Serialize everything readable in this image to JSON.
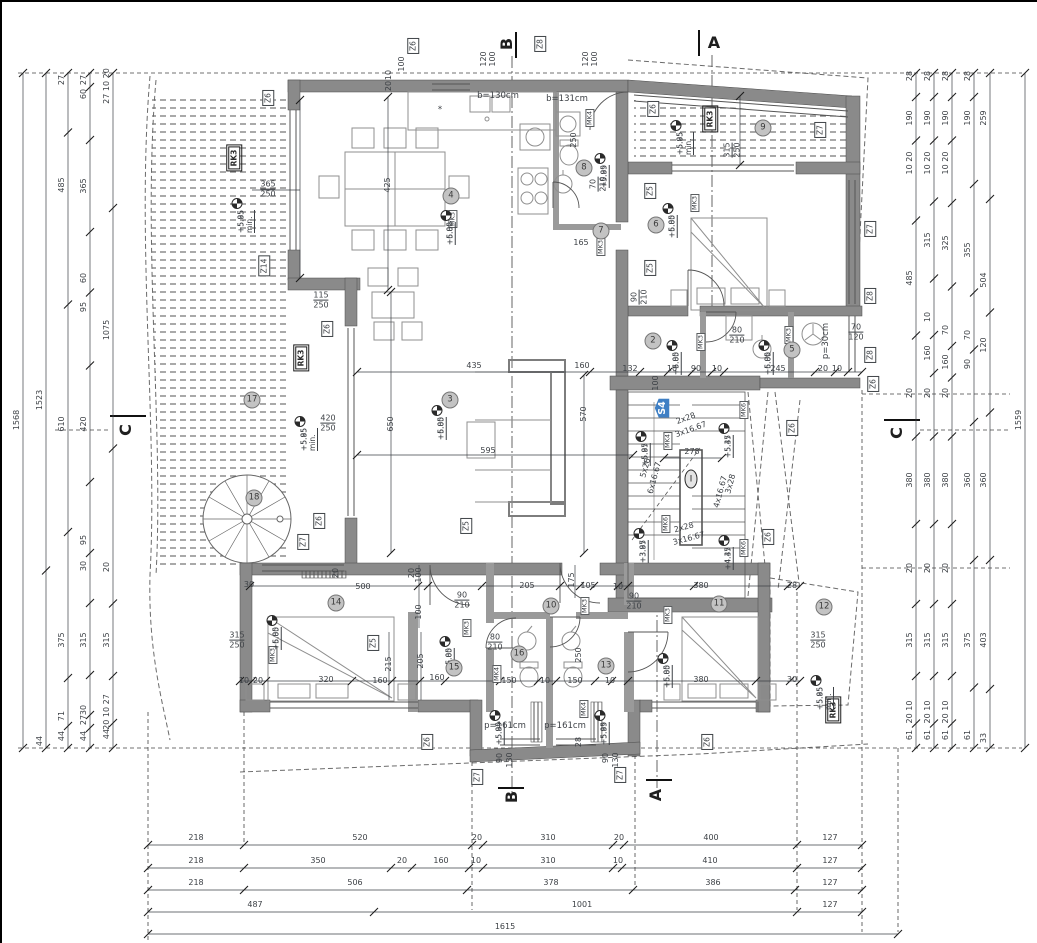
{
  "palette": {
    "wall": "#8a8a8a",
    "wall2": "#9a9a9a",
    "line": "#4a4a4a",
    "furn": "#8f8f8f",
    "text": "#3d4146",
    "accent_blue": "#3f7fc4",
    "bubble": "#c3c3c3"
  },
  "s_tag": {
    "t": "S4",
    "x": 662,
    "y": 408
  },
  "sections": [
    {
      "t": "A",
      "x": 714,
      "y": 43,
      "r": 0
    },
    {
      "t": "A",
      "x": 656,
      "y": 795,
      "r": -90
    },
    {
      "t": "B",
      "x": 507,
      "y": 44,
      "r": -90
    },
    {
      "t": "B",
      "x": 512,
      "y": 797,
      "r": -90
    },
    {
      "t": "C",
      "x": 126,
      "y": 430,
      "r": -90
    },
    {
      "t": "C",
      "x": 897,
      "y": 433,
      "r": -90
    }
  ],
  "window_tags": [
    {
      "t": "Z6",
      "x": 413,
      "y": 46
    },
    {
      "t": "Z8",
      "x": 540,
      "y": 44
    },
    {
      "t": "Z6",
      "x": 268,
      "y": 98
    },
    {
      "t": "Z14",
      "x": 264,
      "y": 266
    },
    {
      "t": "Z6",
      "x": 327,
      "y": 329
    },
    {
      "t": "Z6",
      "x": 319,
      "y": 521
    },
    {
      "t": "Z7",
      "x": 303,
      "y": 542
    },
    {
      "t": "Z5",
      "x": 466,
      "y": 526
    },
    {
      "t": "Z6",
      "x": 653,
      "y": 109
    },
    {
      "t": "Z7",
      "x": 820,
      "y": 130
    },
    {
      "t": "Z5",
      "x": 650,
      "y": 191
    },
    {
      "t": "Z5",
      "x": 650,
      "y": 268
    },
    {
      "t": "Z7",
      "x": 870,
      "y": 229
    },
    {
      "t": "Z8",
      "x": 870,
      "y": 296
    },
    {
      "t": "Z8",
      "x": 870,
      "y": 355
    },
    {
      "t": "Z6",
      "x": 873,
      "y": 384
    },
    {
      "t": "Z6",
      "x": 792,
      "y": 428
    },
    {
      "t": "Z6",
      "x": 768,
      "y": 537
    },
    {
      "t": "Z5",
      "x": 373,
      "y": 643
    },
    {
      "t": "Z6",
      "x": 427,
      "y": 742
    },
    {
      "t": "Z6",
      "x": 707,
      "y": 742
    },
    {
      "t": "Z7",
      "x": 477,
      "y": 777
    },
    {
      "t": "Z7",
      "x": 620,
      "y": 775
    }
  ],
  "mk_tags": [
    {
      "t": "MK3",
      "x": 453,
      "y": 219
    },
    {
      "t": "MK4",
      "x": 590,
      "y": 118
    },
    {
      "t": "MK3",
      "x": 601,
      "y": 247
    },
    {
      "t": "MK3",
      "x": 695,
      "y": 203
    },
    {
      "t": "MK3",
      "x": 701,
      "y": 342
    },
    {
      "t": "MK3",
      "x": 789,
      "y": 335
    },
    {
      "t": "MK4",
      "x": 668,
      "y": 441
    },
    {
      "t": "MK6",
      "x": 744,
      "y": 410
    },
    {
      "t": "MK6",
      "x": 666,
      "y": 524
    },
    {
      "t": "MK6",
      "x": 744,
      "y": 548
    },
    {
      "t": "MK3",
      "x": 273,
      "y": 655
    },
    {
      "t": "MK3",
      "x": 467,
      "y": 628
    },
    {
      "t": "MK4",
      "x": 497,
      "y": 674
    },
    {
      "t": "MK4",
      "x": 584,
      "y": 709
    },
    {
      "t": "MK3",
      "x": 585,
      "y": 606
    },
    {
      "t": "MK3",
      "x": 668,
      "y": 615
    }
  ],
  "rk_tags": [
    {
      "t": "RK3",
      "x": 234,
      "y": 158
    },
    {
      "t": "RK3",
      "x": 301,
      "y": 358
    },
    {
      "t": "RK3",
      "x": 710,
      "y": 119
    },
    {
      "t": "RK3",
      "x": 833,
      "y": 710
    }
  ],
  "levels": [
    {
      "a": "+5.95 min.",
      "b": "+5.85",
      "x": 237,
      "y": 190
    },
    {
      "a": "+6.00",
      "b": "+5.85",
      "x": 446,
      "y": 202
    },
    {
      "a": "+5.99",
      "b": "+5.85",
      "x": 600,
      "y": 145
    },
    {
      "a": "+5.95 min.",
      "b": "+5.85",
      "x": 676,
      "y": 112
    },
    {
      "a": "+6.00",
      "b": "+5.85",
      "x": 668,
      "y": 195
    },
    {
      "a": "+6.00",
      "b": "+5.85",
      "x": 672,
      "y": 332
    },
    {
      "a": "+6.00",
      "b": "+5.85",
      "x": 764,
      "y": 332
    },
    {
      "a": "+6.00",
      "b": "+5.85",
      "x": 437,
      "y": 397
    },
    {
      "a": "+5.95 min.",
      "b": "+5.85",
      "x": 300,
      "y": 408
    },
    {
      "a": "+5.97",
      "b": "+5.85",
      "x": 641,
      "y": 423
    },
    {
      "a": "+5.47",
      "b": "+5.35",
      "x": 724,
      "y": 415
    },
    {
      "a": "+3.97",
      "b": "+3.85",
      "x": 639,
      "y": 520
    },
    {
      "a": "+4.47",
      "b": "+4.35",
      "x": 724,
      "y": 527
    },
    {
      "a": "+6.00",
      "b": "+5.85",
      "x": 272,
      "y": 607
    },
    {
      "a": "+6.00",
      "b": "+5.85",
      "x": 445,
      "y": 628
    },
    {
      "a": "+6.00",
      "b": "+5.85",
      "x": 663,
      "y": 645
    },
    {
      "a": "+5.95 min.",
      "b": "+5.85",
      "x": 816,
      "y": 667
    },
    {
      "a": "+5.99",
      "b": "+5.85",
      "x": 495,
      "y": 702
    },
    {
      "a": "+5.99",
      "b": "+5.85",
      "x": 600,
      "y": 702
    }
  ],
  "room_bubbles": [
    {
      "n": "2",
      "x": 653,
      "y": 341
    },
    {
      "n": "3",
      "x": 450,
      "y": 400
    },
    {
      "n": "4",
      "x": 451,
      "y": 196
    },
    {
      "n": "5",
      "x": 792,
      "y": 350
    },
    {
      "n": "6",
      "x": 656,
      "y": 225
    },
    {
      "n": "7",
      "x": 601,
      "y": 231
    },
    {
      "n": "8",
      "x": 584,
      "y": 168
    },
    {
      "n": "9",
      "x": 763,
      "y": 128
    },
    {
      "n": "10",
      "x": 551,
      "y": 606
    },
    {
      "n": "11",
      "x": 719,
      "y": 604
    },
    {
      "n": "12",
      "x": 824,
      "y": 607
    },
    {
      "n": "13",
      "x": 606,
      "y": 666
    },
    {
      "n": "14",
      "x": 336,
      "y": 603
    },
    {
      "n": "15",
      "x": 454,
      "y": 668
    },
    {
      "n": "16",
      "x": 519,
      "y": 654
    },
    {
      "n": "17",
      "x": 252,
      "y": 400
    },
    {
      "n": "18",
      "x": 254,
      "y": 498
    },
    {
      "n": "I",
      "x": 691,
      "y": 479
    }
  ],
  "dims": [
    {
      "t": "365",
      "t2": "250",
      "x": 268,
      "y": 190
    },
    {
      "t": "425",
      "x": 388,
      "y": 185,
      "r": -90
    },
    {
      "t": "115",
      "t2": "250",
      "x": 321,
      "y": 301
    },
    {
      "t": "420",
      "t2": "250",
      "x": 328,
      "y": 424
    },
    {
      "t": "650",
      "x": 391,
      "y": 424,
      "r": -90
    },
    {
      "t": "435",
      "x": 474,
      "y": 366
    },
    {
      "t": "160",
      "x": 582,
      "y": 366
    },
    {
      "t": "570",
      "x": 584,
      "y": 414,
      "r": -90
    },
    {
      "t": "595",
      "x": 488,
      "y": 451
    },
    {
      "t": "100",
      "x": 402,
      "y": 64,
      "r": -90
    },
    {
      "t": "10",
      "x": 389,
      "y": 75,
      "r": -90
    },
    {
      "t": "20",
      "x": 389,
      "y": 86,
      "r": -90
    },
    {
      "t": "120",
      "x": 484,
      "y": 59,
      "r": -90
    },
    {
      "t": "100",
      "x": 493,
      "y": 59,
      "r": -90
    },
    {
      "t": "120",
      "x": 586,
      "y": 59,
      "r": -90
    },
    {
      "t": "100",
      "x": 595,
      "y": 59,
      "r": -90
    },
    {
      "t": "250",
      "x": 574,
      "y": 140,
      "r": -90
    },
    {
      "t": "70",
      "t2": "210",
      "x": 599,
      "y": 184,
      "r": -90
    },
    {
      "t": "165",
      "x": 581,
      "y": 243
    },
    {
      "t": "315",
      "t2": "250",
      "x": 733,
      "y": 150,
      "r": -90
    },
    {
      "t": "90",
      "t2": "210",
      "x": 640,
      "y": 297,
      "r": -90
    },
    {
      "t": "80",
      "t2": "210",
      "x": 737,
      "y": 336
    },
    {
      "t": "70",
      "t2": "120",
      "x": 856,
      "y": 333
    },
    {
      "t": "132",
      "x": 630,
      "y": 369
    },
    {
      "t": "10",
      "x": 672,
      "y": 369
    },
    {
      "t": "90",
      "x": 696,
      "y": 369
    },
    {
      "t": "10",
      "x": 717,
      "y": 369
    },
    {
      "t": "245",
      "x": 778,
      "y": 369
    },
    {
      "t": "20",
      "x": 823,
      "y": 369
    },
    {
      "t": "10",
      "x": 837,
      "y": 369
    },
    {
      "t": "100",
      "x": 656,
      "y": 383,
      "r": -90
    },
    {
      "t": "278",
      "x": 692,
      "y": 452
    },
    {
      "t": "500",
      "x": 363,
      "y": 587
    },
    {
      "t": "100",
      "x": 419,
      "y": 575,
      "r": -90
    },
    {
      "t": "100",
      "x": 419,
      "y": 612,
      "r": -90
    },
    {
      "t": "205",
      "x": 527,
      "y": 586
    },
    {
      "t": "175",
      "x": 572,
      "y": 580,
      "r": -90
    },
    {
      "t": "105",
      "x": 588,
      "y": 586
    },
    {
      "t": "10",
      "x": 618,
      "y": 587
    },
    {
      "t": "90",
      "t2": "210",
      "x": 634,
      "y": 602
    },
    {
      "t": "90",
      "t2": "210",
      "x": 462,
      "y": 601
    },
    {
      "t": "80",
      "t2": "210",
      "x": 495,
      "y": 643
    },
    {
      "t": "380",
      "x": 701,
      "y": 586
    },
    {
      "t": "28",
      "x": 792,
      "y": 586
    },
    {
      "t": "315",
      "t2": "250",
      "x": 237,
      "y": 641
    },
    {
      "t": "315",
      "t2": "250",
      "x": 818,
      "y": 641
    },
    {
      "t": "215",
      "x": 389,
      "y": 664,
      "r": -90
    },
    {
      "t": "205",
      "x": 421,
      "y": 661,
      "r": -90
    },
    {
      "t": "250",
      "x": 579,
      "y": 655,
      "r": -90
    },
    {
      "t": "320",
      "x": 326,
      "y": 680
    },
    {
      "t": "10",
      "x": 244,
      "y": 681
    },
    {
      "t": "20",
      "x": 258,
      "y": 681
    },
    {
      "t": "160",
      "x": 380,
      "y": 681
    },
    {
      "t": "160",
      "x": 437,
      "y": 678
    },
    {
      "t": "150",
      "x": 509,
      "y": 681
    },
    {
      "t": "10",
      "x": 545,
      "y": 681
    },
    {
      "t": "150",
      "x": 575,
      "y": 681
    },
    {
      "t": "10",
      "x": 610,
      "y": 681
    },
    {
      "t": "380",
      "x": 701,
      "y": 680
    },
    {
      "t": "30",
      "x": 792,
      "y": 680
    },
    {
      "t": "90",
      "x": 500,
      "y": 758,
      "r": -90
    },
    {
      "t": "130",
      "x": 510,
      "y": 760,
      "r": -90
    },
    {
      "t": "90",
      "x": 606,
      "y": 758,
      "r": -90
    },
    {
      "t": "130",
      "x": 616,
      "y": 760,
      "r": -90
    },
    {
      "t": "28",
      "x": 579,
      "y": 742,
      "r": -90
    },
    {
      "t": "20",
      "x": 336,
      "y": 573,
      "r": -90
    },
    {
      "t": "20",
      "x": 412,
      "y": 573,
      "r": -90
    },
    {
      "t": "30",
      "x": 249,
      "y": 585
    }
  ],
  "stair_notes": [
    {
      "t": "2x28",
      "x": 686,
      "y": 419,
      "r": -20
    },
    {
      "t": "3x16.67",
      "x": 691,
      "y": 430,
      "r": -20
    },
    {
      "t": "5x28",
      "x": 646,
      "y": 468,
      "r": -75
    },
    {
      "t": "6x16.67",
      "x": 655,
      "y": 478,
      "r": -75
    },
    {
      "t": "3x28",
      "x": 731,
      "y": 484,
      "r": -75
    },
    {
      "t": "4x16.67",
      "x": 721,
      "y": 492,
      "r": -75
    },
    {
      "t": "2x28",
      "x": 684,
      "y": 528,
      "r": -15
    },
    {
      "t": "3x16.67",
      "x": 689,
      "y": 539,
      "r": -15
    }
  ],
  "notes": [
    {
      "t": "b=130cm",
      "x": 498,
      "y": 96
    },
    {
      "t": "b=131cm",
      "x": 567,
      "y": 99
    },
    {
      "t": "p=161cm",
      "x": 505,
      "y": 726
    },
    {
      "t": "p=161cm",
      "x": 565,
      "y": 726
    },
    {
      "t": "p=30cm",
      "x": 826,
      "y": 341,
      "r": -90
    },
    {
      "t": "*",
      "x": 440,
      "y": 110
    }
  ],
  "v_chains": [
    {
      "x": 23,
      "labels": [
        {
          "t": "1568",
          "y": 420
        }
      ]
    },
    {
      "x": 46,
      "labels": [
        {
          "t": "1523",
          "y": 400
        },
        {
          "t": "44",
          "y": 741
        }
      ]
    },
    {
      "x": 68,
      "labels": [
        {
          "t": "27",
          "y": 80
        },
        {
          "t": "485",
          "y": 185
        },
        {
          "t": "610",
          "y": 424
        },
        {
          "t": "375",
          "y": 640
        },
        {
          "t": "71",
          "y": 716
        },
        {
          "t": "44",
          "y": 736
        }
      ]
    },
    {
      "x": 90,
      "labels": [
        {
          "t": "27",
          "y": 80
        },
        {
          "t": "60",
          "y": 94
        },
        {
          "t": "365",
          "y": 186
        },
        {
          "t": "60",
          "y": 278
        },
        {
          "t": "95",
          "y": 307
        },
        {
          "t": "420",
          "y": 424
        },
        {
          "t": "95",
          "y": 540
        },
        {
          "t": "30",
          "y": 566
        },
        {
          "t": "315",
          "y": 640
        },
        {
          "t": "30",
          "y": 710
        },
        {
          "t": "27",
          "y": 720
        },
        {
          "t": "44",
          "y": 736
        }
      ]
    },
    {
      "x": 113,
      "labels": [
        {
          "t": "27 10 20",
          "y": 86
        },
        {
          "t": "1075",
          "y": 330
        },
        {
          "t": "20",
          "y": 567
        },
        {
          "t": "315",
          "y": 640
        },
        {
          "t": "20 10 27",
          "y": 712
        },
        {
          "t": "44",
          "y": 734
        }
      ]
    },
    {
      "x": 916,
      "labels": [
        {
          "t": "28",
          "y": 76
        },
        {
          "t": "190",
          "y": 118
        },
        {
          "t": "10 20",
          "y": 163
        },
        {
          "t": "485",
          "y": 278
        },
        {
          "t": "20",
          "y": 393
        },
        {
          "t": "380",
          "y": 480
        },
        {
          "t": "20",
          "y": 568
        },
        {
          "t": "315",
          "y": 640
        },
        {
          "t": "20 10",
          "y": 712
        },
        {
          "t": "61",
          "y": 735
        }
      ]
    },
    {
      "x": 934,
      "labels": [
        {
          "t": "28",
          "y": 76
        },
        {
          "t": "190",
          "y": 118
        },
        {
          "t": "10 20",
          "y": 163
        },
        {
          "t": "315",
          "y": 240
        },
        {
          "t": "10",
          "y": 317
        },
        {
          "t": "160",
          "y": 353
        },
        {
          "t": "20",
          "y": 393
        },
        {
          "t": "380",
          "y": 480
        },
        {
          "t": "20",
          "y": 568
        },
        {
          "t": "315",
          "y": 640
        },
        {
          "t": "20 10",
          "y": 712
        },
        {
          "t": "61",
          "y": 735
        }
      ]
    },
    {
      "x": 952,
      "labels": [
        {
          "t": "28",
          "y": 76
        },
        {
          "t": "190",
          "y": 118
        },
        {
          "t": "10 20",
          "y": 163
        },
        {
          "t": "325",
          "y": 243
        },
        {
          "t": "70",
          "y": 330
        },
        {
          "t": "160",
          "y": 362
        },
        {
          "t": "20",
          "y": 393
        },
        {
          "t": "380",
          "y": 480
        },
        {
          "t": "20",
          "y": 568
        },
        {
          "t": "315",
          "y": 640
        },
        {
          "t": "20 10",
          "y": 712
        },
        {
          "t": "61",
          "y": 735
        }
      ]
    },
    {
      "x": 974,
      "labels": [
        {
          "t": "28",
          "y": 76
        },
        {
          "t": "190",
          "y": 118
        },
        {
          "t": "355",
          "y": 250
        },
        {
          "t": "70",
          "y": 335
        },
        {
          "t": "90",
          "y": 364
        },
        {
          "t": "360",
          "y": 480
        },
        {
          "t": "375",
          "y": 640
        },
        {
          "t": "61",
          "y": 735
        }
      ]
    },
    {
      "x": 990,
      "labels": [
        {
          "t": "259",
          "y": 118
        },
        {
          "t": "504",
          "y": 280
        },
        {
          "t": "120",
          "y": 345
        },
        {
          "t": "360",
          "y": 480
        },
        {
          "t": "403",
          "y": 640
        },
        {
          "t": "33",
          "y": 738
        }
      ]
    },
    {
      "x": 1025,
      "labels": [
        {
          "t": "1559",
          "y": 420
        }
      ]
    }
  ],
  "h_rows": [
    {
      "y": 845,
      "stops": [
        148,
        244,
        472,
        483,
        613,
        624,
        797,
        862
      ],
      "labels": [
        {
          "t": "218",
          "x": 196
        },
        {
          "t": "520",
          "x": 360
        },
        {
          "t": "20",
          "x": 477
        },
        {
          "t": "310",
          "x": 548
        },
        {
          "t": "20",
          "x": 619
        },
        {
          "t": "400",
          "x": 711
        },
        {
          "t": "127",
          "x": 830
        }
      ]
    },
    {
      "y": 868,
      "stops": [
        148,
        244,
        391,
        412,
        469,
        483,
        613,
        622,
        797,
        862
      ],
      "labels": [
        {
          "t": "218",
          "x": 196
        },
        {
          "t": "350",
          "x": 318
        },
        {
          "t": "20",
          "x": 402
        },
        {
          "t": "160",
          "x": 441
        },
        {
          "t": "10",
          "x": 476
        },
        {
          "t": "310",
          "x": 548
        },
        {
          "t": "10",
          "x": 618
        },
        {
          "t": "410",
          "x": 710
        },
        {
          "t": "127",
          "x": 830
        }
      ]
    },
    {
      "y": 890,
      "stops": [
        148,
        244,
        467,
        633,
        795,
        862
      ],
      "labels": [
        {
          "t": "218",
          "x": 196
        },
        {
          "t": "506",
          "x": 355
        },
        {
          "t": "378",
          "x": 551
        },
        {
          "t": "386",
          "x": 713
        },
        {
          "t": "127",
          "x": 830
        }
      ]
    },
    {
      "y": 912,
      "stops": [
        148,
        374,
        797,
        862
      ],
      "labels": [
        {
          "t": "487",
          "x": 255
        },
        {
          "t": "1001",
          "x": 582
        },
        {
          "t": "127",
          "x": 830
        }
      ]
    },
    {
      "y": 934,
      "stops": [
        148,
        898
      ],
      "labels": [
        {
          "t": "1615",
          "x": 505
        }
      ]
    }
  ]
}
